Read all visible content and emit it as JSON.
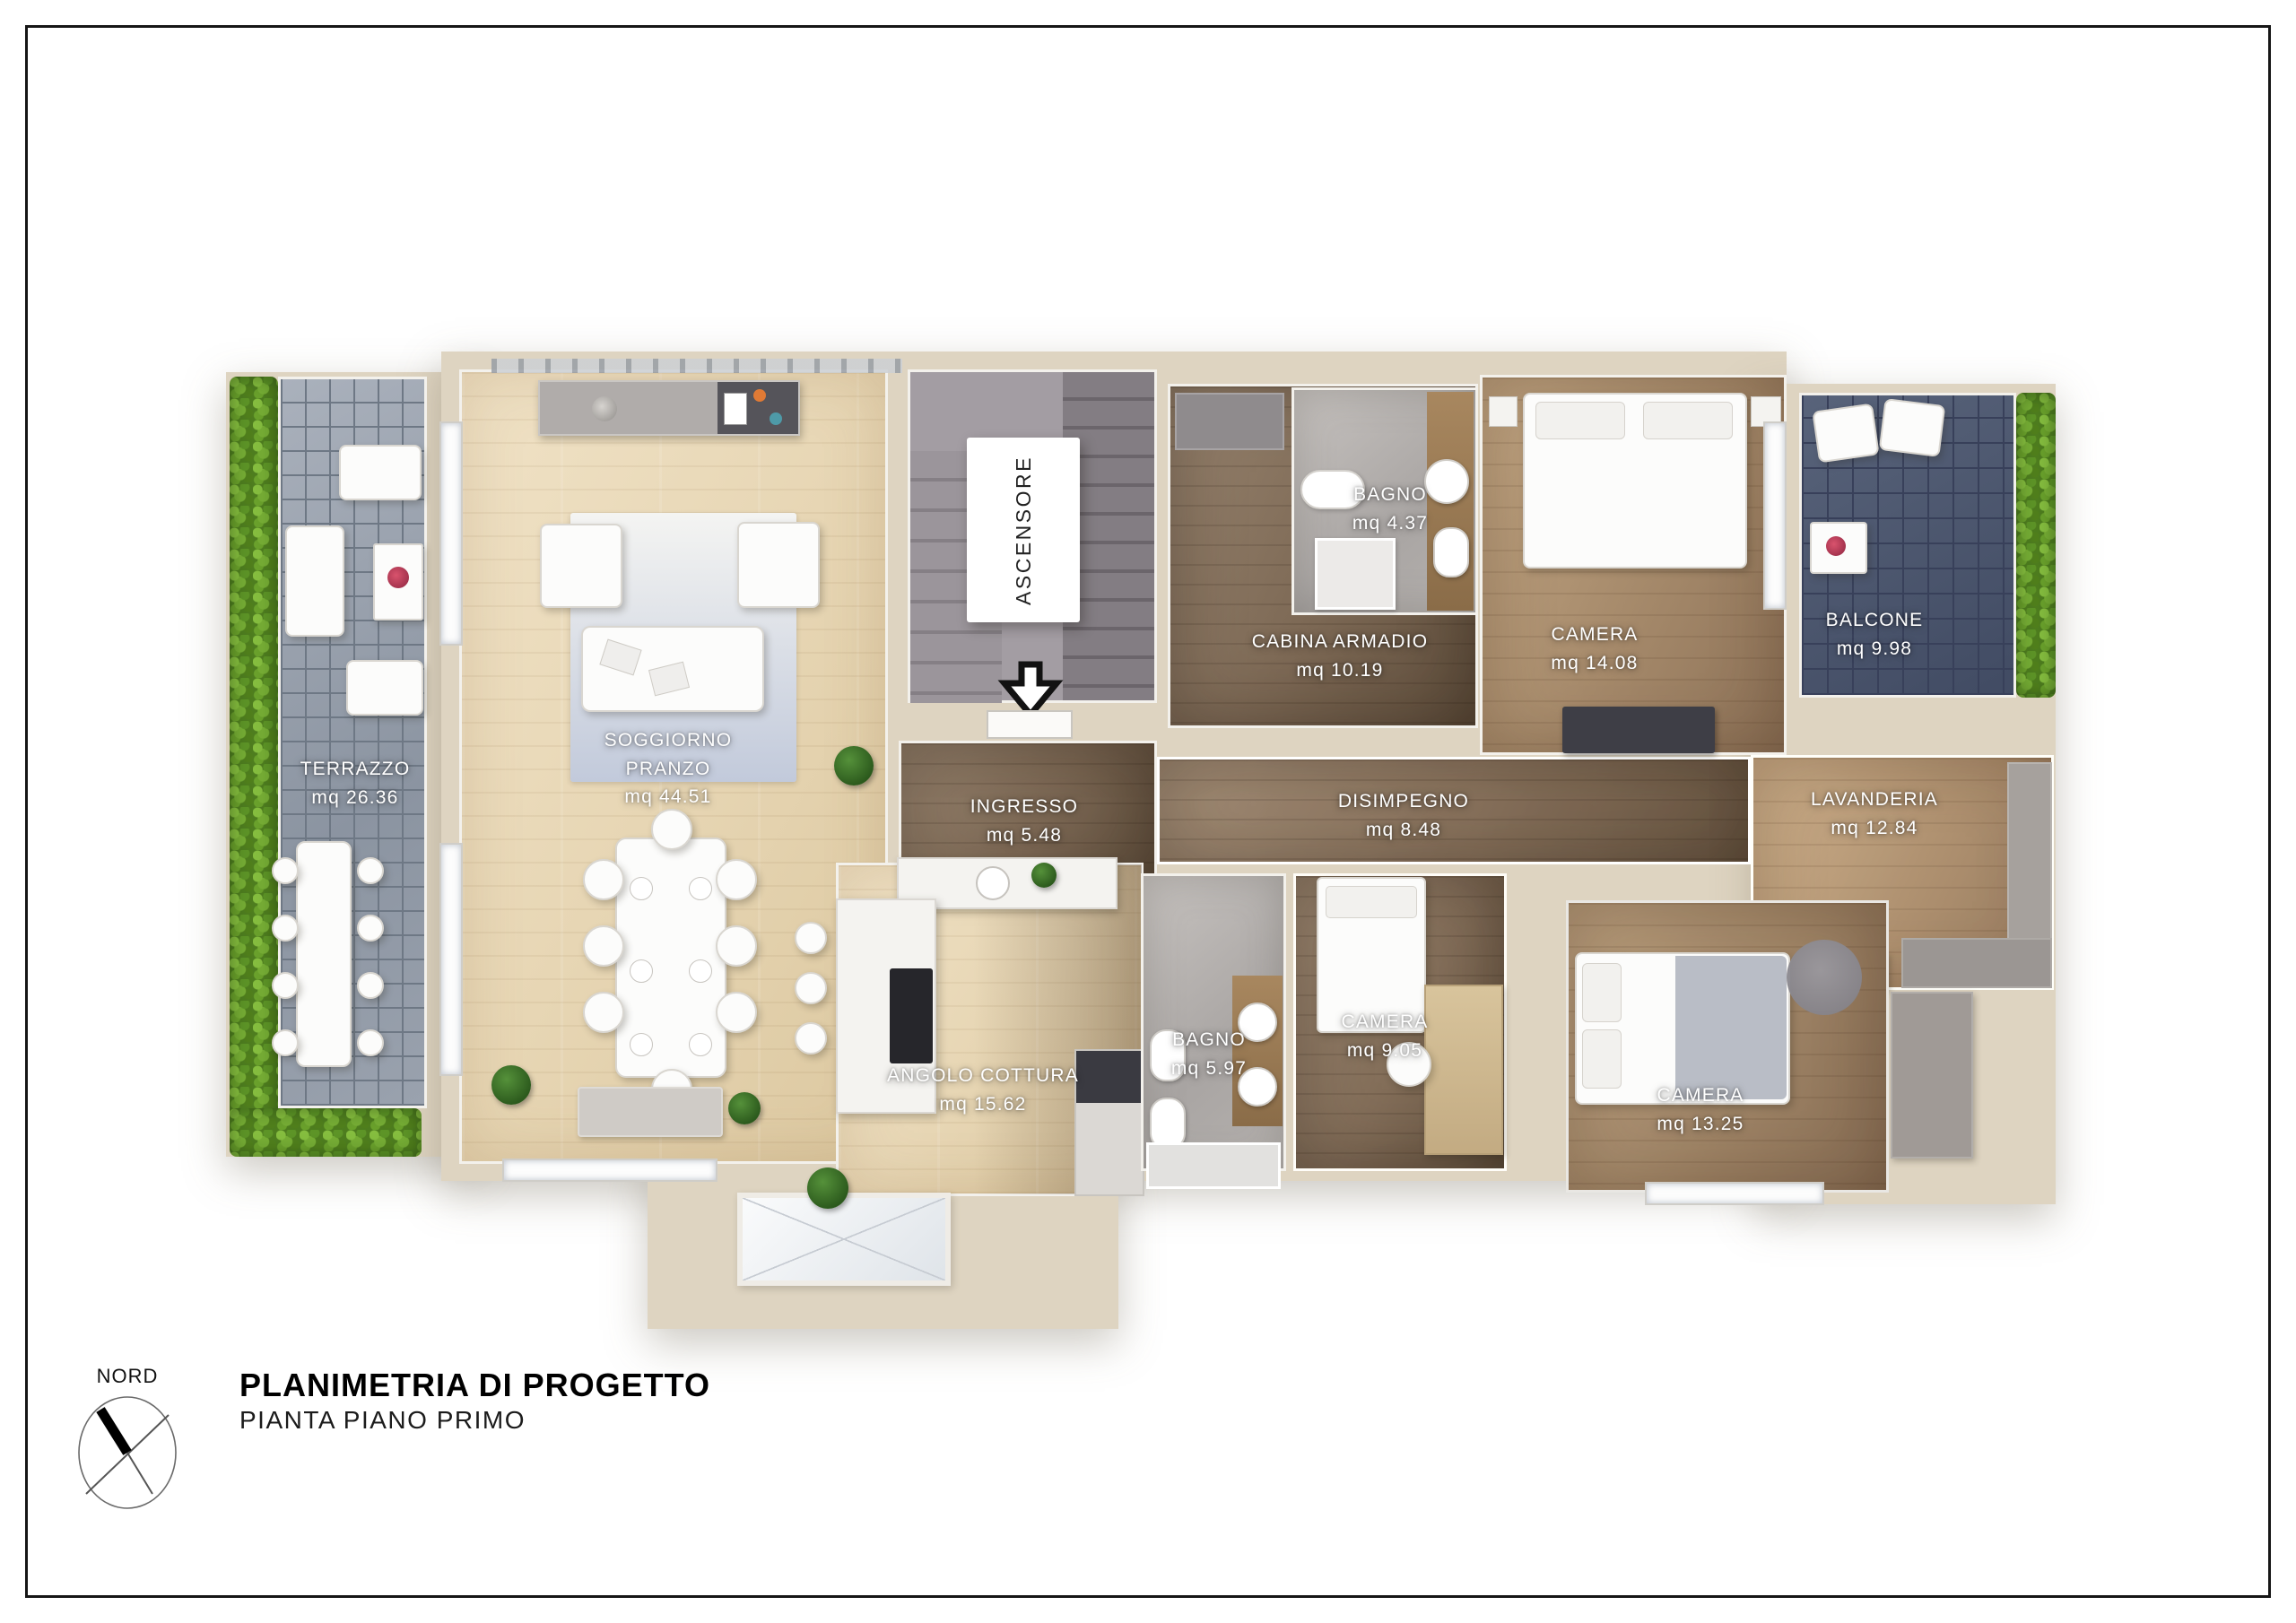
{
  "titleblock": {
    "compass_label": "NORD",
    "title": "PLANIMETRIA DI PROGETTO",
    "subtitle": "PIANTA PIANO PRIMO"
  },
  "plan": {
    "elevator_label": "ASCENSORE"
  },
  "rooms": {
    "terrazzo": {
      "name": "TERRAZZO",
      "area": "mq 26.36"
    },
    "soggiorno": {
      "name": "SOGGIORNO PRANZO",
      "area": "mq 44.51"
    },
    "ingresso": {
      "name": "INGRESSO",
      "area": "mq 5.48"
    },
    "bagno_piccolo": {
      "name": "BAGNO",
      "area": "mq 4.37"
    },
    "cabina_armadio": {
      "name": "CABINA ARMADIO",
      "area": "mq 10.19"
    },
    "camera_grande": {
      "name": "CAMERA",
      "area": "mq 14.08"
    },
    "balcone": {
      "name": "BALCONE",
      "area": "mq 9.98"
    },
    "disimpegno": {
      "name": "DISIMPEGNO",
      "area": "mq 8.48"
    },
    "lavanderia": {
      "name": "LAVANDERIA",
      "area": "mq 12.84"
    },
    "angolo_cottura": {
      "name": "ANGOLO COTTURA",
      "area": "mq 15.62"
    },
    "bagno_grande": {
      "name": "BAGNO",
      "area": "mq 5.97"
    },
    "camera_singola": {
      "name": "CAMERA",
      "area": "mq 9.05"
    },
    "camera_doppia": {
      "name": "CAMERA",
      "area": "mq 13.25"
    }
  },
  "colors": {
    "exterior_wall": "#ded4c1",
    "interior_wall": "#f3f1ec",
    "wood_light": "#e7d6b4",
    "wood_dark": "#7c6854",
    "tile_terrace": "#9aa2ae",
    "tile_balcony": "#4a5468",
    "hedge_green": "#4e7d1f",
    "label_text": "#ffffff"
  }
}
